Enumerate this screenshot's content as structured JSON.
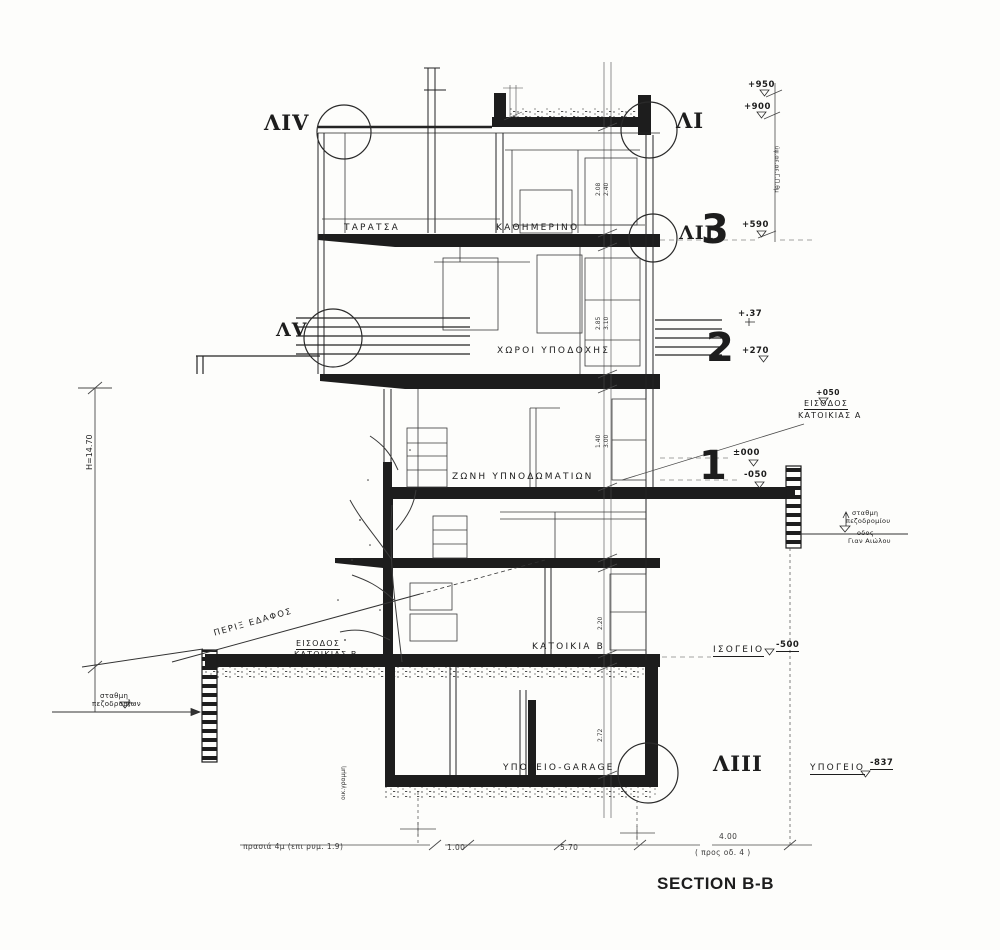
{
  "title": "SECTION B-B",
  "colors": {
    "ink": "#1d1d1d",
    "paper": "#fdfdfb"
  },
  "markers": {
    "l1": "ΛI",
    "l2": "ΛII",
    "l3": "ΛIII",
    "l4": "ΛIV",
    "l5": "ΛV"
  },
  "floors": {
    "third": "3",
    "second": "2",
    "first": "1"
  },
  "rooms": {
    "terrace": "ΤΑΡΑΤΣΑ",
    "living": "ΚΑΘΗΜΕΡΙΝΟ",
    "reception": "ΧΩΡΟΙ ΥΠΟΔΟΧΗΣ",
    "bedroom_zone": "ΖΩΝΗ  ΥΠΝΟΔΩΜΑΤΙΩΝ",
    "residence_b": "ΚΑΤΟΙΚΙΑ Β",
    "garage": "ΥΠΟΓΕΙΟ-GARAGE"
  },
  "elevations": {
    "e950": "+950",
    "e900": "+900",
    "e590": "+590",
    "e37": "+.37",
    "e270": "+270",
    "e050": "+050",
    "e000": "±000",
    "em050": "-050",
    "em500": "-500",
    "em837": "-837"
  },
  "notes": {
    "entrance_a1": "ΕΙΣΟΔΟΣ",
    "entrance_a2": "ΚΑΤΟΙΚΙΑΣ Α",
    "entrance_b1": "ΕΙΣΟΔΟΣ",
    "entrance_b2": "ΚΑΤΟΙΚΙΑΣ Β",
    "ground_label": "ΙΣΟΓΕΙΟ",
    "basement_label": "ΥΠΟΓΕΙΟ",
    "sidewalk_r1": "σταθμη",
    "sidewalk_r2": "πεζοδρομίου",
    "street_r1": "οδος",
    "street_r2": "Γιαν Αιώλου",
    "sidewalk_l1": "σταθμη",
    "sidewalk_l2": "πεζοδρομίων",
    "slope": "ΠΕΡΙΞ  ΕΔΑΦΟΣ",
    "height": "H=14.70",
    "scribble_right": "ύψ.αε.αε.Γ.Π.θμ",
    "building_line": "οικ.γραμμη"
  },
  "dims": {
    "chain": [
      "2.08",
      "2.40",
      "2.85",
      "3.10",
      "1.40",
      "3.00",
      "2.20",
      "2.72"
    ],
    "bottom_note": "πρασιά 4μ (επι ρυμ. 1.9)",
    "b1": "1.00",
    "b2": "5.70",
    "b3": "4.00",
    "b3n": "( προς οδ. 4 )"
  }
}
